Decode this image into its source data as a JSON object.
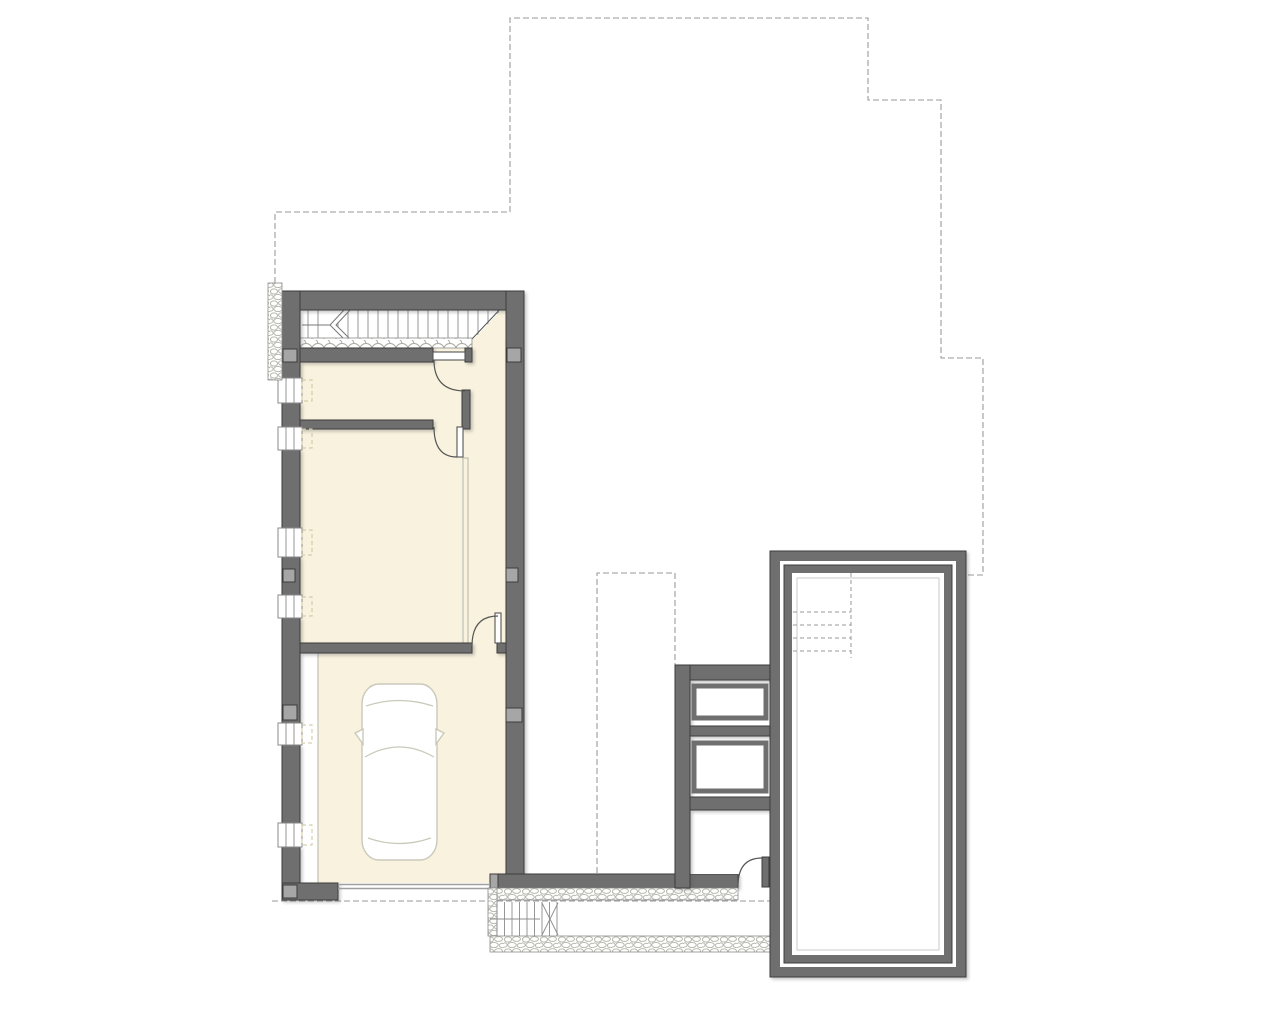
{
  "page": {
    "background": "#ffffff"
  },
  "colors": {
    "background": "#ffffff",
    "wall_fill": "#6f6f6f",
    "wall_edge": "#3c3c3c",
    "floor_cream": "#f8f2de",
    "line_light": "#bcbcb2",
    "line_mid": "#8c8c8c",
    "dash_gray": "#9a9a9a",
    "marker_gray": "#a6a6a6",
    "pebble_stroke": "#b8b8af",
    "car_stroke": "#c9c9bb",
    "door_line": "#555555",
    "window_frame": "#8a8a8a",
    "reveal_dash": "#cfc49e",
    "pool_inner_line": "#c9c9c9"
  },
  "plan": {
    "drawing_type": "architectural-floor-plan",
    "stair": {
      "tread_count": 20,
      "tread_x_start": 308,
      "tread_spacing": 10
    },
    "exterior_stair": {
      "step_count": 9,
      "step_x_start": 497,
      "step_spacing": 7.5
    },
    "pool": {
      "step_line_count": 4,
      "step_y_start": 612,
      "step_spacing": 13
    },
    "left_wall_windows": [
      {
        "y": 378,
        "h": 25
      },
      {
        "y": 427,
        "h": 23
      },
      {
        "y": 528,
        "h": 29
      },
      {
        "y": 595,
        "h": 23
      },
      {
        "y": 723,
        "h": 22
      },
      {
        "y": 823,
        "h": 24
      }
    ],
    "column_markers": [
      [
        283,
        349,
        14,
        13
      ],
      [
        283,
        569,
        12,
        13
      ],
      [
        283,
        705,
        14,
        15
      ],
      [
        283,
        885,
        14,
        13
      ],
      [
        507,
        348,
        14,
        14
      ],
      [
        506,
        568,
        12,
        14
      ],
      [
        506,
        708,
        16,
        14
      ]
    ],
    "storage_box_count": 2,
    "car_count": 1
  }
}
